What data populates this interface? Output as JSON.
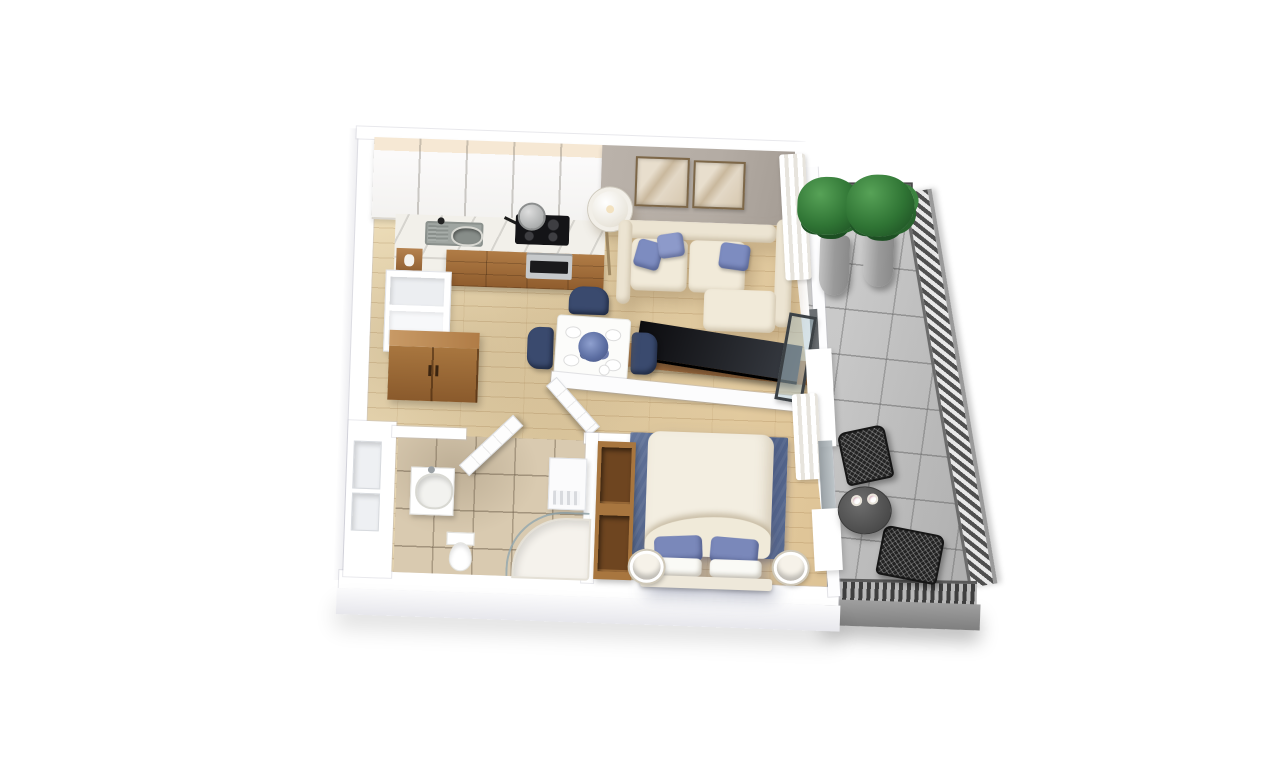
{
  "scene": {
    "type": "3d-floor-plan-render",
    "view": "isometric-top-down",
    "background": "#ffffff",
    "text_on_screen": "none"
  },
  "palette": {
    "woodFloorLight": "#eedfbc",
    "woodFloorDark": "#ddc193",
    "accentWall": "#b4aca4",
    "litStrip": "#f6e8d4",
    "counterMarble": "#f2f0ea",
    "baseCabinetWood": "#b07c46",
    "wardrobeWood": "#a8763f",
    "sofaCream": "#ece4d2",
    "cushionBlue": "#7d8cc0",
    "chairNavy": "#3a4a6e",
    "tableWhite": "#fcfcfa",
    "tvBlack": "#3a3e45",
    "consoleWood": "#9b6a3e",
    "rugBlue": "#4e6087",
    "duvetCream": "#f3eee1",
    "pillowBlue": "#7a88ba",
    "tileBeige": "#d9cab0",
    "balconyTile": "#cbcbcb",
    "railingDark": "#4f4f4f",
    "plantGreen": "#2f7434",
    "potGray": "#9a9a9a",
    "patioBlack": "#232323",
    "steel": "#c6c9cb",
    "lampWarm": "#f3e2c0"
  },
  "apartment": {
    "rooms": [
      {
        "id": "kitchen",
        "items": [
          "white-upper-cabinets-with-lighting",
          "marble-counter",
          "double-sink-with-faucet",
          "cooktop-4-burners",
          "pot-on-stove",
          "oven",
          "wood-base-cabinets",
          "tall-white-cabinet",
          "open-shelf-with-vase"
        ]
      },
      {
        "id": "living-room",
        "items": [
          "l-shaped-cream-sofa",
          "blue-throw-pillows-x3",
          "framed-artworks-x2",
          "floor-lamp",
          "tv-on-wood-console",
          "sheer-curtains",
          "open-glass-balcony-door",
          "gray-accent-wall"
        ]
      },
      {
        "id": "dining-area",
        "items": [
          "white-square-table",
          "navy-chairs-x3",
          "blue-flower-centerpiece",
          "plates-x4",
          "cup"
        ]
      },
      {
        "id": "hallway",
        "items": [
          "wood-wardrobe",
          "white-storage-cabinet"
        ]
      },
      {
        "id": "bathroom",
        "items": [
          "wash-basin-unit",
          "toilet",
          "corner-shower",
          "storage-unit",
          "beige-tile-floor",
          "door-ajar",
          "wall-niches-x2"
        ]
      },
      {
        "id": "bedroom",
        "items": [
          "double-bed-white-duvet",
          "blue-pillows-x2",
          "white-pillows-x2",
          "blue-area-rug",
          "round-bedside-lamps-x2",
          "open-wood-shelf-unit",
          "white-closet-pier",
          "sheer-curtains",
          "door-ajar"
        ]
      },
      {
        "id": "balcony",
        "items": [
          "potted-plants-x2",
          "round-bistro-table",
          "cups-x2",
          "black-wire-chairs-x2",
          "gray-stone-tile-floor",
          "metal-slat-railing"
        ]
      }
    ]
  }
}
